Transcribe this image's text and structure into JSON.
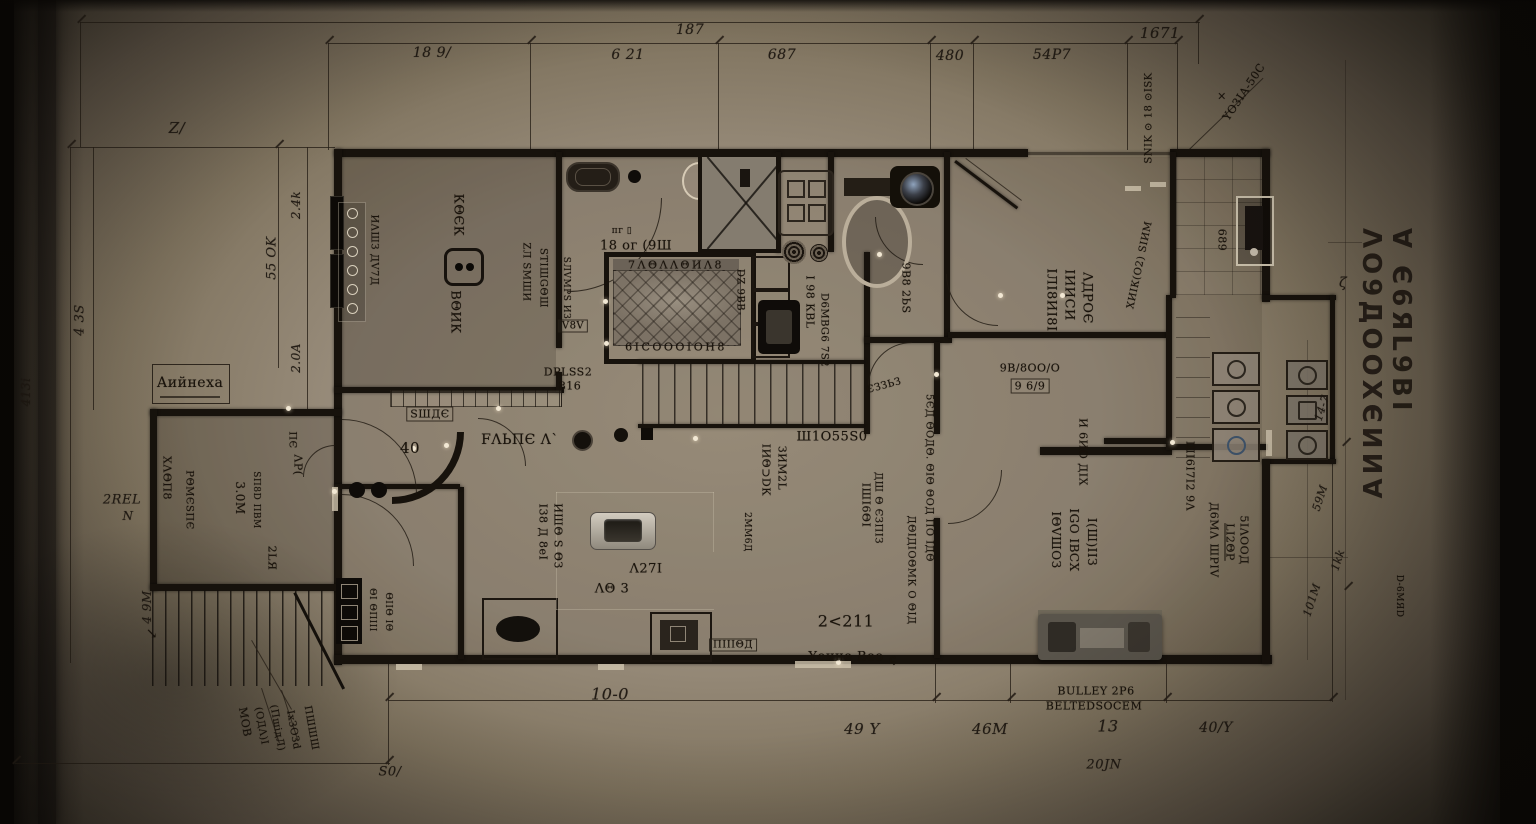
{
  "document": {
    "kind": "architectural floor plan (photographed blueprint)",
    "sheet_vertical_title": "∀ Є6ЯL9ВI ΛО9ДООХЄИИ∀",
    "colors": {
      "paper_center": "#a69a85",
      "paper_edge": "#2b2620",
      "wall_ink": "#17120c",
      "text_ink": "#18120b",
      "highlight_dot": "#f2e8d4"
    }
  },
  "labels": [
    {
      "id": "dim-top-overall",
      "t": "187",
      "x": 690,
      "y": 30,
      "r": 0,
      "s": 14,
      "c": "it"
    },
    {
      "id": "dim-top-right-overall",
      "t": "1671",
      "x": 1160,
      "y": 33,
      "r": 0,
      "s": 15,
      "c": "it"
    },
    {
      "id": "dim-top-1",
      "t": "18 9/",
      "x": 432,
      "y": 53,
      "r": 0,
      "s": 14,
      "c": "it"
    },
    {
      "id": "dim-top-2",
      "t": "6 21",
      "x": 628,
      "y": 55,
      "r": 0,
      "s": 14,
      "c": "it"
    },
    {
      "id": "dim-top-3",
      "t": "687",
      "x": 782,
      "y": 55,
      "r": 0,
      "s": 14,
      "c": "it"
    },
    {
      "id": "dim-top-4",
      "t": "480",
      "x": 950,
      "y": 56,
      "r": 0,
      "s": 14,
      "c": "it"
    },
    {
      "id": "dim-top-5",
      "t": "54P7",
      "x": 1052,
      "y": 55,
      "r": 0,
      "s": 14,
      "c": "it"
    },
    {
      "id": "dim-left-z",
      "t": "Z/",
      "x": 177,
      "y": 128,
      "r": 0,
      "s": 15,
      "c": "it"
    },
    {
      "id": "dim-left-1",
      "t": "4 3S",
      "x": 80,
      "y": 320,
      "r": -90,
      "s": 13,
      "c": "it"
    },
    {
      "id": "dim-left-2",
      "t": "2.4k",
      "x": 296,
      "y": 205,
      "r": -90,
      "s": 12,
      "c": "it"
    },
    {
      "id": "dim-left-3",
      "t": "55 OK",
      "x": 272,
      "y": 258,
      "r": -90,
      "s": 13,
      "c": "it"
    },
    {
      "id": "dim-left-4",
      "t": "2.0A",
      "x": 296,
      "y": 358,
      "r": -90,
      "s": 12,
      "c": "it"
    },
    {
      "id": "dim-left-5",
      "t": "2REL",
      "x": 122,
      "y": 500,
      "r": 0,
      "s": 13,
      "c": "it"
    },
    {
      "id": "dim-left-6",
      "t": "N",
      "x": 128,
      "y": 516,
      "r": 0,
      "s": 12,
      "c": "it"
    },
    {
      "id": "dim-left-7",
      "t": "413i",
      "x": 26,
      "y": 392,
      "r": -90,
      "s": 12,
      "c": "it"
    },
    {
      "id": "dim-left-8",
      "t": "4 9M",
      "x": 147,
      "y": 607,
      "r": -90,
      "s": 12,
      "c": "it"
    },
    {
      "id": "north-arrow",
      "t": "↘",
      "x": 152,
      "y": 634,
      "r": 0,
      "s": 14,
      "c": ""
    },
    {
      "id": "dim-bottom-overall",
      "t": "10-0",
      "x": 610,
      "y": 694,
      "r": 0,
      "s": 16,
      "c": "it"
    },
    {
      "id": "dim-bottom-s0",
      "t": "S0/",
      "x": 390,
      "y": 772,
      "r": 0,
      "s": 13,
      "c": "it"
    },
    {
      "id": "dim-bottom-1",
      "t": "49 Y",
      "x": 862,
      "y": 729,
      "r": 0,
      "s": 15,
      "c": "it"
    },
    {
      "id": "dim-bottom-2",
      "t": "46M",
      "x": 990,
      "y": 729,
      "r": 0,
      "s": 15,
      "c": "it"
    },
    {
      "id": "dim-bottom-3",
      "t": "13",
      "x": 1108,
      "y": 726,
      "r": 0,
      "s": 16,
      "c": "it"
    },
    {
      "id": "note-bulley",
      "t": "BULLEY 2P6",
      "x": 1096,
      "y": 691,
      "r": 0,
      "s": 11,
      "c": ""
    },
    {
      "id": "note-belted",
      "t": "BELTEDSOCEM",
      "x": 1094,
      "y": 706,
      "r": 0,
      "s": 11,
      "c": ""
    },
    {
      "id": "dim-bottom-4",
      "t": "20JN",
      "x": 1104,
      "y": 765,
      "r": 0,
      "s": 13,
      "c": "it"
    },
    {
      "id": "dim-bottom-5",
      "t": "40/Y",
      "x": 1216,
      "y": 728,
      "r": 0,
      "s": 14,
      "c": "it"
    },
    {
      "id": "dim-right-1",
      "t": "14-7",
      "x": 1322,
      "y": 408,
      "r": -72,
      "s": 11,
      "c": "it"
    },
    {
      "id": "dim-right-2",
      "t": "59M",
      "x": 1320,
      "y": 498,
      "r": -72,
      "s": 11,
      "c": "it"
    },
    {
      "id": "dim-right-3",
      "t": "1kk",
      "x": 1338,
      "y": 560,
      "r": -72,
      "s": 11,
      "c": "it"
    },
    {
      "id": "dim-right-4",
      "t": "101M",
      "x": 1312,
      "y": 600,
      "r": -72,
      "s": 11,
      "c": "it"
    },
    {
      "id": "dim-right-zeta",
      "t": "ζ",
      "x": 1343,
      "y": 283,
      "r": 0,
      "s": 14,
      "c": "it"
    },
    {
      "id": "margin-note-tr",
      "t": "SNIK ⊙ 18 ⊙ISK",
      "x": 1149,
      "y": 118,
      "r": -90,
      "s": 10,
      "c": ""
    },
    {
      "id": "leader-note-tr",
      "t": "YO3IA-50C",
      "x": 1244,
      "y": 92,
      "r": -56,
      "s": 11,
      "c": ""
    },
    {
      "id": "marker-x",
      "t": "×",
      "x": 1222,
      "y": 96,
      "r": 0,
      "s": 11,
      "c": ""
    },
    {
      "id": "room1-schedule-note",
      "t": "ИΛШЗ ДV7Д",
      "x": 374,
      "y": 250,
      "r": 90,
      "s": 10,
      "c": ""
    },
    {
      "id": "room1-name-a",
      "t": "КΘЄК",
      "x": 458,
      "y": 215,
      "r": 90,
      "s": 13,
      "c": ""
    },
    {
      "id": "room1-name-b",
      "t": "ВΘИК",
      "x": 455,
      "y": 312,
      "r": 90,
      "s": 13,
      "c": ""
    },
    {
      "id": "hall-note-a",
      "t": "ZЛ SМШИ",
      "x": 526,
      "y": 272,
      "r": 90,
      "s": 10,
      "c": ""
    },
    {
      "id": "hall-note-b",
      "t": "SТIШGΘШ",
      "x": 543,
      "y": 278,
      "r": 90,
      "s": 10,
      "c": ""
    },
    {
      "id": "hall-note-c",
      "t": "SЛVМРS ИЗ",
      "x": 566,
      "y": 288,
      "r": 90,
      "s": 9,
      "c": ""
    },
    {
      "id": "hall-tag",
      "t": "V8V",
      "x": 573,
      "y": 326,
      "r": 0,
      "s": 10,
      "c": "boxed"
    },
    {
      "id": "hall-note-d",
      "t": "DPLSS2",
      "x": 568,
      "y": 372,
      "r": 0,
      "s": 11,
      "c": ""
    },
    {
      "id": "hall-note-e",
      "t": "816",
      "x": 570,
      "y": 386,
      "r": 0,
      "s": 11,
      "c": ""
    },
    {
      "id": "bath-fixture-tag",
      "t": "пг ▯",
      "x": 622,
      "y": 231,
      "r": 0,
      "s": 9,
      "c": ""
    },
    {
      "id": "bath-name",
      "t": "18 ог (9Ш",
      "x": 636,
      "y": 246,
      "r": 0,
      "s": 13,
      "c": ""
    },
    {
      "id": "bed-head-text",
      "t": "7ΛΘΛΛΘИΛ8",
      "x": 676,
      "y": 265,
      "r": 0,
      "s": 11,
      "c": "ls2"
    },
    {
      "id": "bed-foot-text",
      "t": "6IСОООIОН8",
      "x": 676,
      "y": 347,
      "r": 0,
      "s": 11,
      "c": "ls2"
    },
    {
      "id": "corridor-note-a",
      "t": "DZ 9ВВ",
      "x": 740,
      "y": 290,
      "r": 90,
      "s": 10,
      "c": ""
    },
    {
      "id": "corridor-note-b",
      "t": "I 98 КВL",
      "x": 810,
      "y": 302,
      "r": 90,
      "s": 11,
      "c": ""
    },
    {
      "id": "corridor-note-c",
      "t": "D6МВG6 7S2",
      "x": 824,
      "y": 330,
      "r": 90,
      "s": 10,
      "c": ""
    },
    {
      "id": "wc-note",
      "t": "9В8 2ЬS",
      "x": 906,
      "y": 288,
      "r": 90,
      "s": 11,
      "c": ""
    },
    {
      "id": "room-tr-name-1",
      "t": "IЛI8ИI8I",
      "x": 1051,
      "y": 300,
      "r": 90,
      "s": 13,
      "c": ""
    },
    {
      "id": "room-tr-name-2",
      "t": "IИИСИ",
      "x": 1069,
      "y": 295,
      "r": 90,
      "s": 13,
      "c": ""
    },
    {
      "id": "room-tr-name-3",
      "t": "ΛДРОЄ",
      "x": 1087,
      "y": 298,
      "r": 90,
      "s": 13,
      "c": ""
    },
    {
      "id": "room-tr-note",
      "t": "ХИIК(О2) SIИМ",
      "x": 1140,
      "y": 265,
      "r": -78,
      "s": 10,
      "c": ""
    },
    {
      "id": "room-tr-tag-a",
      "t": "9В/8ОО/О",
      "x": 1030,
      "y": 368,
      "r": 0,
      "s": 11,
      "c": ""
    },
    {
      "id": "room-tr-tag-b",
      "t": "9 6/9",
      "x": 1030,
      "y": 386,
      "r": 0,
      "s": 11,
      "c": "boxed"
    },
    {
      "id": "room-tr-note2",
      "t": "И 6ИО ДIХ",
      "x": 1083,
      "y": 452,
      "r": 90,
      "s": 11,
      "c": ""
    },
    {
      "id": "porch-tag",
      "t": "689",
      "x": 1222,
      "y": 240,
      "r": 90,
      "s": 11,
      "c": ""
    },
    {
      "id": "kitchen-name",
      "t": "ШI6I7I2 9Λ",
      "x": 1190,
      "y": 476,
      "r": 90,
      "s": 11,
      "c": ""
    },
    {
      "id": "stair-name",
      "t": "Ш1О55S0",
      "x": 832,
      "y": 437,
      "r": 0,
      "s": 13,
      "c": ""
    },
    {
      "id": "hall2-note-a",
      "t": "IИΘ⊃DК",
      "x": 766,
      "y": 470,
      "r": 90,
      "s": 11,
      "c": ""
    },
    {
      "id": "hall2-note-b",
      "t": "ЗИМ2L",
      "x": 782,
      "y": 468,
      "r": 90,
      "s": 11,
      "c": ""
    },
    {
      "id": "hall2-note-c",
      "t": "2ММ6Д",
      "x": 747,
      "y": 532,
      "r": 90,
      "s": 9,
      "c": ""
    },
    {
      "id": "hall2-note-d",
      "t": "IШI6ΘI",
      "x": 866,
      "y": 505,
      "r": 90,
      "s": 11,
      "c": ""
    },
    {
      "id": "hall2-note-e",
      "t": "ДШ Θ ЄЗПIЗ",
      "x": 878,
      "y": 508,
      "r": 90,
      "s": 10,
      "c": ""
    },
    {
      "id": "spine-note-a",
      "t": "5ЄД ΘОДΘ. ΘIΘ ΘОД ПО IДΘ",
      "x": 929,
      "y": 478,
      "r": 90,
      "s": 10,
      "c": ""
    },
    {
      "id": "spine-note-b",
      "t": "ДΘIДIОΘМК О ΘIД",
      "x": 911,
      "y": 570,
      "r": 90,
      "s": 10,
      "c": ""
    },
    {
      "id": "hall2-area",
      "t": "2<211",
      "x": 846,
      "y": 621,
      "r": 0,
      "s": 16,
      "c": ""
    },
    {
      "id": "hall2-name",
      "t": "Yоине Вео",
      "x": 846,
      "y": 657,
      "r": 0,
      "s": 13,
      "c": ""
    },
    {
      "id": "hall2-sigma",
      "t": "ς",
      "x": 893,
      "y": 659,
      "r": 0,
      "s": 11,
      "c": ""
    },
    {
      "id": "hall2-curve-note",
      "t": "ЄЗЗЬЗ",
      "x": 884,
      "y": 386,
      "r": -15,
      "s": 10,
      "c": ""
    },
    {
      "id": "hall2-tag",
      "t": "ПIIIΘД",
      "x": 733,
      "y": 645,
      "r": 0,
      "s": 10,
      "c": "boxed"
    },
    {
      "id": "room-br-name-1",
      "t": "IΘVШОЗ",
      "x": 1056,
      "y": 540,
      "r": 90,
      "s": 12,
      "c": ""
    },
    {
      "id": "room-br-name-2",
      "t": "IGО IВСХ",
      "x": 1074,
      "y": 540,
      "r": 90,
      "s": 12,
      "c": ""
    },
    {
      "id": "room-br-name-3",
      "t": "I(Ш)IIЗ",
      "x": 1092,
      "y": 542,
      "r": 90,
      "s": 12,
      "c": ""
    },
    {
      "id": "room-br-note-1",
      "t": "Д6МΛ ШРIV",
      "x": 1214,
      "y": 540,
      "r": 90,
      "s": 11,
      "c": ""
    },
    {
      "id": "room-br-note-2",
      "t": "LI2ΘР",
      "x": 1230,
      "y": 542,
      "r": 90,
      "s": 11,
      "c": "ul"
    },
    {
      "id": "room-br-note-3",
      "t": "5IΛООД",
      "x": 1244,
      "y": 540,
      "r": 90,
      "s": 11,
      "c": ""
    },
    {
      "id": "entry-tag",
      "t": "SШДЄ",
      "x": 430,
      "y": 414,
      "r": 0,
      "s": 11,
      "c": "boxed"
    },
    {
      "id": "entry-num",
      "t": "40",
      "x": 410,
      "y": 448,
      "r": 0,
      "s": 15,
      "c": ""
    },
    {
      "id": "entry-name",
      "t": "FΛЬПЄ Λ`",
      "x": 520,
      "y": 440,
      "r": 0,
      "s": 14,
      "c": ""
    },
    {
      "id": "entry-note-a",
      "t": "I38 Д 8еI",
      "x": 543,
      "y": 532,
      "r": 90,
      "s": 11,
      "c": ""
    },
    {
      "id": "entry-note-b",
      "t": "ИШΘ S ΘЗ",
      "x": 558,
      "y": 536,
      "r": 90,
      "s": 11,
      "c": ""
    },
    {
      "id": "garage-tag-a",
      "t": "Λ27I",
      "x": 646,
      "y": 569,
      "r": 0,
      "s": 13,
      "c": ""
    },
    {
      "id": "garage-tag-b",
      "t": "ΛΘ 3",
      "x": 612,
      "y": 589,
      "r": 0,
      "s": 13,
      "c": ""
    },
    {
      "id": "garage-note-a",
      "t": "ΘI ΘПIII",
      "x": 372,
      "y": 610,
      "r": 90,
      "s": 9,
      "c": ""
    },
    {
      "id": "garage-note-b",
      "t": "ΘIIΘ IΘ",
      "x": 388,
      "y": 612,
      "r": 90,
      "s": 9,
      "c": ""
    },
    {
      "id": "annex-note-1",
      "t": "ХΛΘП8",
      "x": 167,
      "y": 478,
      "r": 90,
      "s": 11,
      "c": ""
    },
    {
      "id": "annex-note-2",
      "t": "РΘМЄSПЄ",
      "x": 189,
      "y": 500,
      "r": 90,
      "s": 10,
      "c": ""
    },
    {
      "id": "annex-area",
      "t": "3.0М",
      "x": 240,
      "y": 498,
      "r": 90,
      "s": 12,
      "c": ""
    },
    {
      "id": "annex-note-3",
      "t": "SП8D ПВМ",
      "x": 256,
      "y": 500,
      "r": 90,
      "s": 9,
      "c": ""
    },
    {
      "id": "annex-note-4",
      "t": "ПЄ",
      "x": 292,
      "y": 440,
      "r": 90,
      "s": 10,
      "c": ""
    },
    {
      "id": "annex-note-5",
      "t": "ΛР(",
      "x": 298,
      "y": 465,
      "r": 90,
      "s": 11,
      "c": ""
    },
    {
      "id": "annex-note-6",
      "t": "2LЯ",
      "x": 272,
      "y": 558,
      "r": 90,
      "s": 11,
      "c": ""
    },
    {
      "id": "annex-label",
      "t": "Аийнеха",
      "x": 190,
      "y": 383,
      "r": 0,
      "s": 14,
      "c": ""
    },
    {
      "id": "stairs-note-1",
      "t": "МОВ",
      "x": 245,
      "y": 722,
      "r": 80,
      "s": 11,
      "c": ""
    },
    {
      "id": "stairs-note-2",
      "t": "(ОДΛ)I",
      "x": 261,
      "y": 726,
      "r": 80,
      "s": 10,
      "c": ""
    },
    {
      "id": "stairs-note-3",
      "t": "(ПшідЛ)",
      "x": 277,
      "y": 728,
      "r": 80,
      "s": 10,
      "c": ""
    },
    {
      "id": "stairs-note-4",
      "t": "IхЗОЗd",
      "x": 293,
      "y": 730,
      "r": 80,
      "s": 10,
      "c": ""
    },
    {
      "id": "stairs-note-5",
      "t": "ПШШШ",
      "x": 311,
      "y": 728,
      "r": 80,
      "s": 10,
      "c": ""
    },
    {
      "id": "sheet-note",
      "t": "D-6МЯD",
      "x": 1399,
      "y": 596,
      "r": 90,
      "s": 9,
      "c": ""
    }
  ]
}
